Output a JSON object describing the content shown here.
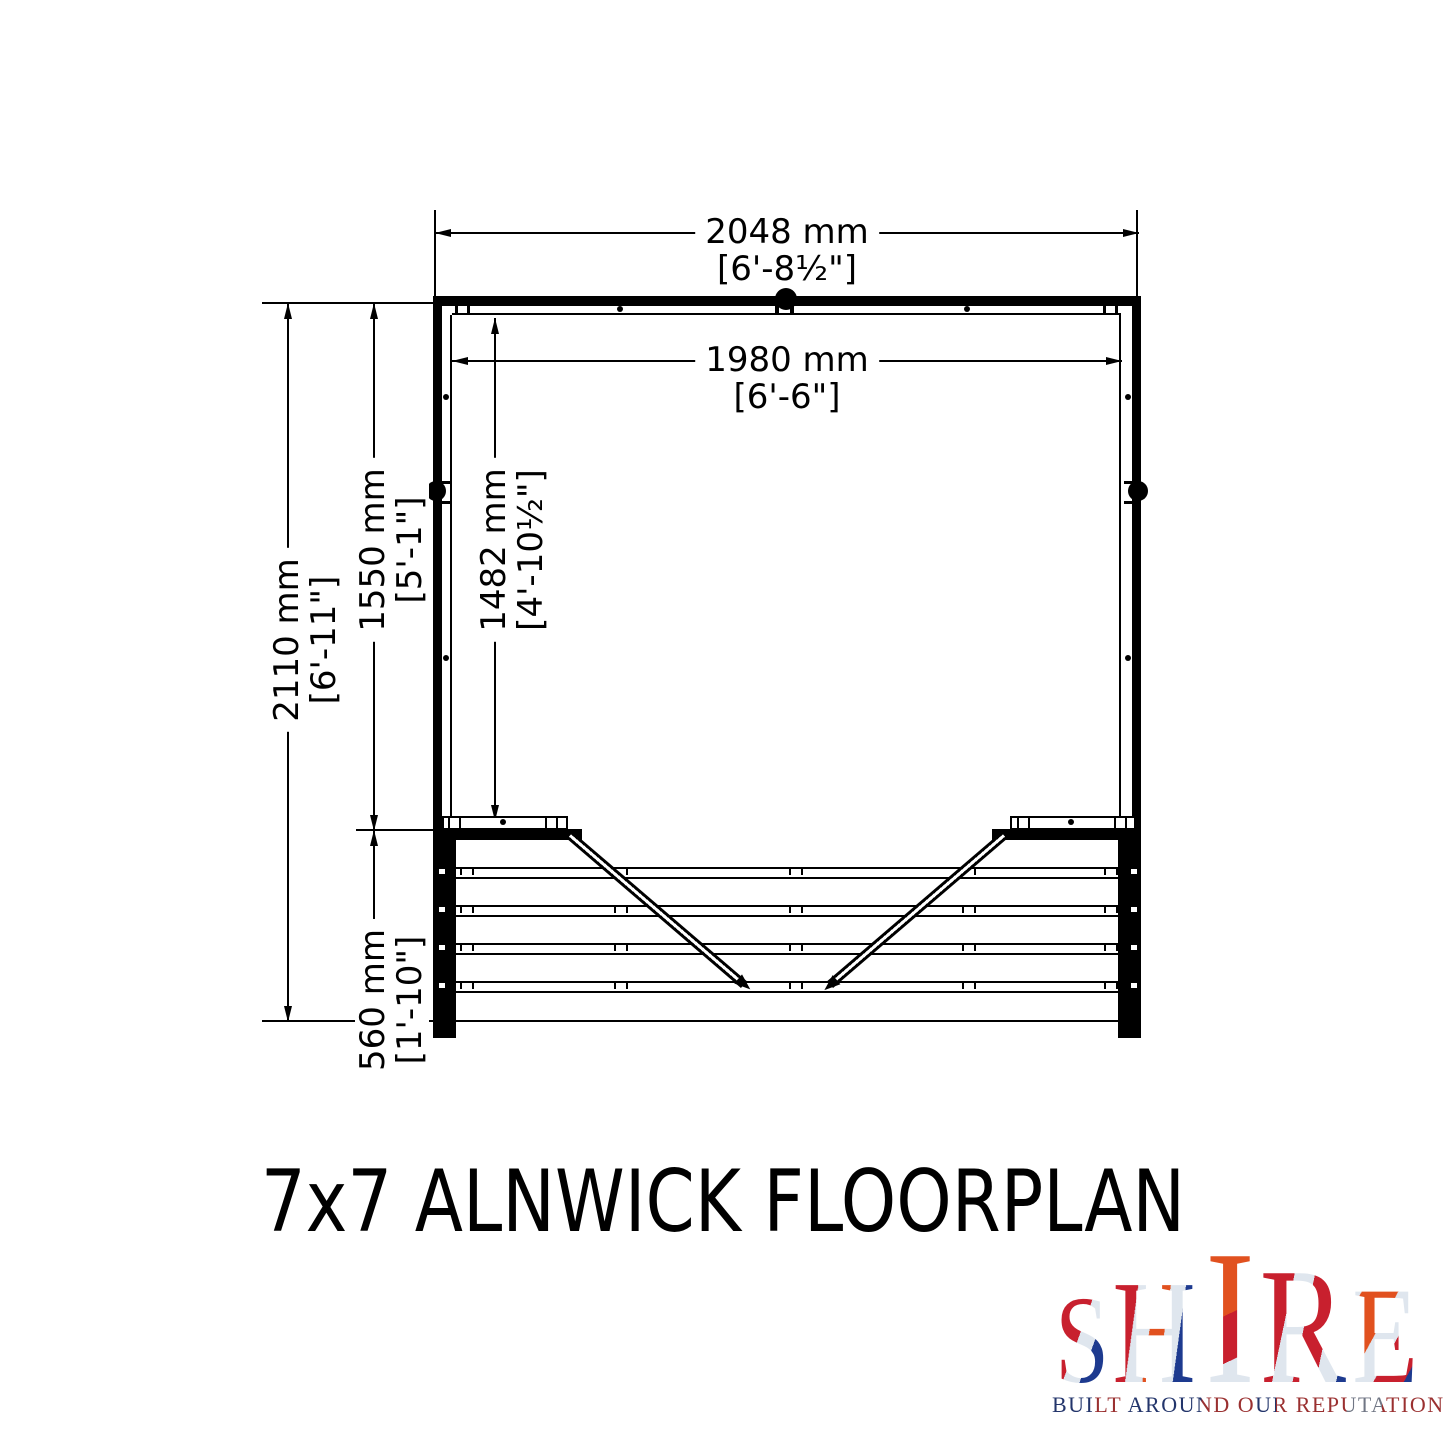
{
  "title": "7x7 ALNWICK FLOORPLAN",
  "floorplan": {
    "dims": {
      "outer_width": {
        "metric": "2048 mm",
        "imperial": "[6'-8½\"]"
      },
      "inner_width": {
        "metric": "1980 mm",
        "imperial": "[6'-6\"]"
      },
      "total_depth": {
        "metric": "2110 mm",
        "imperial": "[6'-11\"]"
      },
      "main_depth": {
        "metric": "1550 mm",
        "imperial": "[5'-1\"]"
      },
      "inner_depth": {
        "metric": "1482 mm",
        "imperial": "[4'-10½\"]"
      },
      "veranda_depth": {
        "metric": "560 mm",
        "imperial": "[1'-10\"]"
      }
    }
  },
  "logo": {
    "brand_letters": [
      "S",
      "H",
      "I",
      "R",
      "E"
    ],
    "tagline": "BUILT AROUND OUR REPUTATION",
    "colors": {
      "red": "#c8202e",
      "orange": "#e1511f",
      "navy": "#1d3a8f",
      "silver": "#dfe6ee"
    }
  },
  "drawing": {
    "line_color": "#000000",
    "background": "#ffffff"
  }
}
